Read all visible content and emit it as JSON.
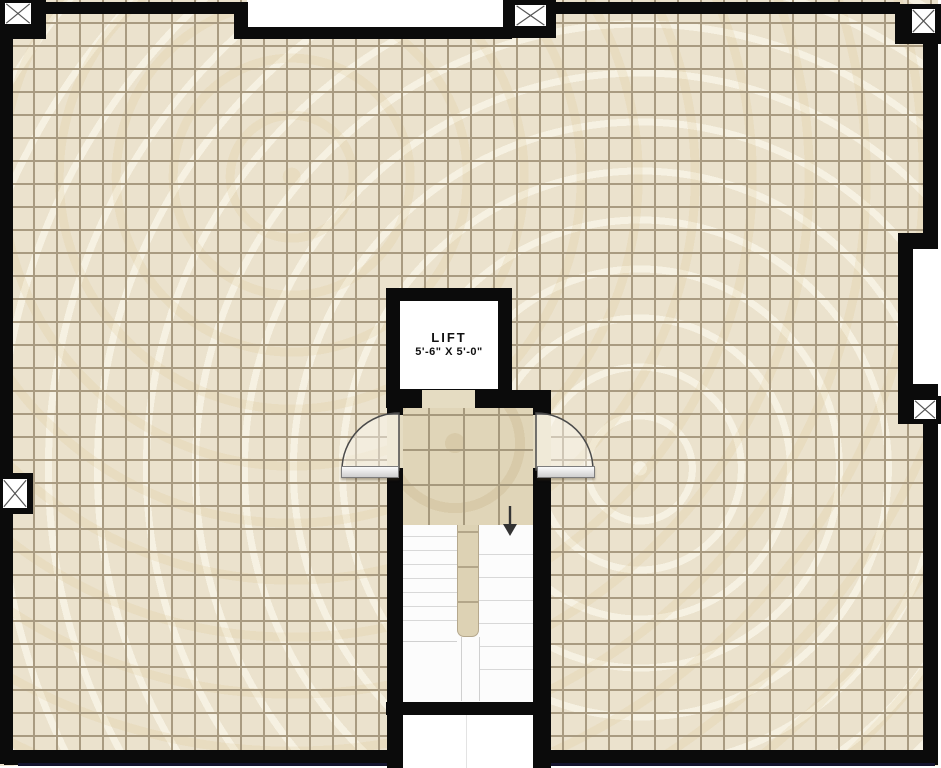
{
  "plan": {
    "type": "floor-plan",
    "lift": {
      "label": "LIFT",
      "size": "5'-6\" X 5'-0\""
    },
    "stairs": {
      "direction": "down",
      "flights": 2,
      "left_flight_steps": 7,
      "right_flight_steps": 6
    },
    "doors": {
      "count": 2,
      "type": "single-swing",
      "swing": "outward-into-room"
    },
    "column_markers": {
      "count": 5,
      "symbol": "x-cross"
    }
  },
  "colors": {
    "wall": "#0b0b0b",
    "floor_tile": "#ebe2cd",
    "floor_grout": "#a99b81",
    "lobby_tile": "#e0d5b8",
    "lobby_grout": "#a6997d",
    "stair_floor": "#fcfcfc",
    "step_line": "#d8d8d8",
    "outside": "#ffffff",
    "bottom_line": "#14142e",
    "door_arc": "#4a4a4a"
  }
}
